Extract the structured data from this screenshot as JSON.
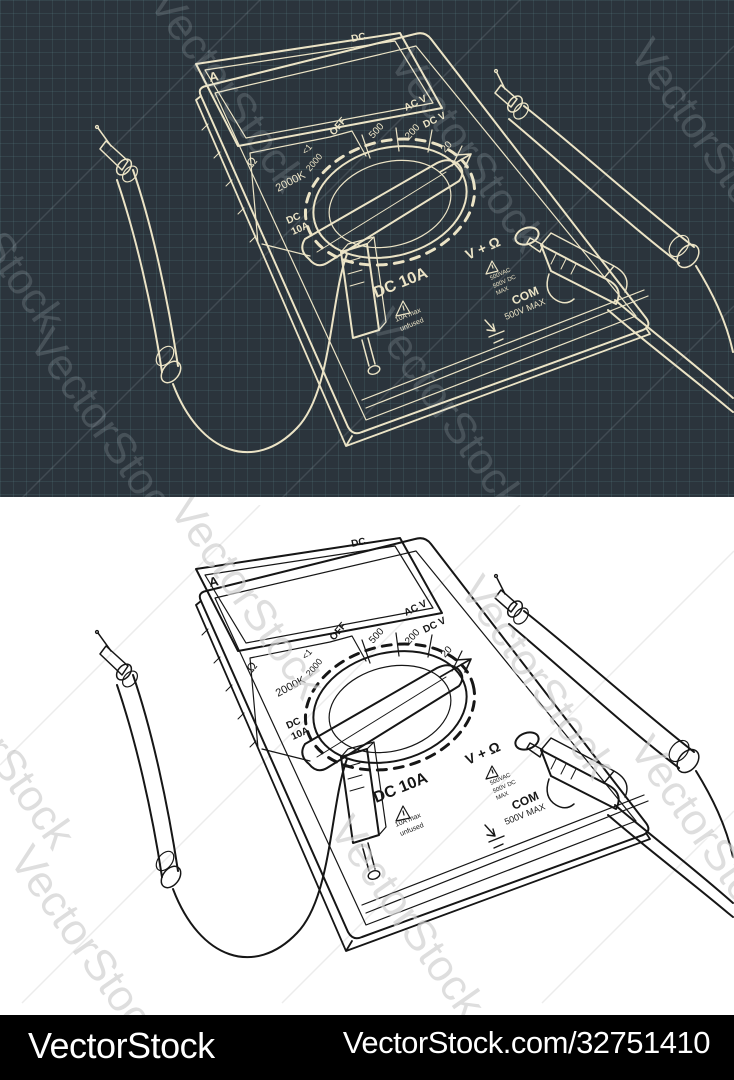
{
  "image": {
    "width": 734,
    "height": 1080
  },
  "watermark": {
    "text": "VectorStock"
  },
  "panels": {
    "dark": {
      "background": "#2b343c",
      "grid_color": "#4a6569",
      "line_color": "#ece4c6"
    },
    "light": {
      "background": "#ffffff",
      "line_color": "#161616"
    }
  },
  "multimeter": {
    "display": {
      "value": "025.0",
      "unit_label": "A",
      "mode_label": "DC"
    },
    "dial": {
      "off_label": "OFF",
      "voltage_headers": {
        "ac": "AC V",
        "dc": "DC V"
      },
      "voltage_ranges": [
        "500",
        "200",
        "20"
      ],
      "resistance_symbol": "Ω",
      "resistance_ranges": [
        "<1",
        "2000",
        "2000K"
      ],
      "current_range": {
        "line1": "DC",
        "line2": "10A"
      }
    },
    "jacks": {
      "dc10a": {
        "label": "DC 10A",
        "warning_line1": "10A max",
        "warning_line2": "unfused"
      },
      "v_ohm": {
        "label": "V + Ω",
        "warning_line1": "500VAC",
        "warning_line2": "500V DC",
        "warning_line3": "MAX"
      },
      "com": {
        "label": "COM",
        "rating": "500V MAX"
      }
    }
  },
  "footer": {
    "brand": "VectorStock",
    "url": "VectorStock.com/32751410"
  }
}
